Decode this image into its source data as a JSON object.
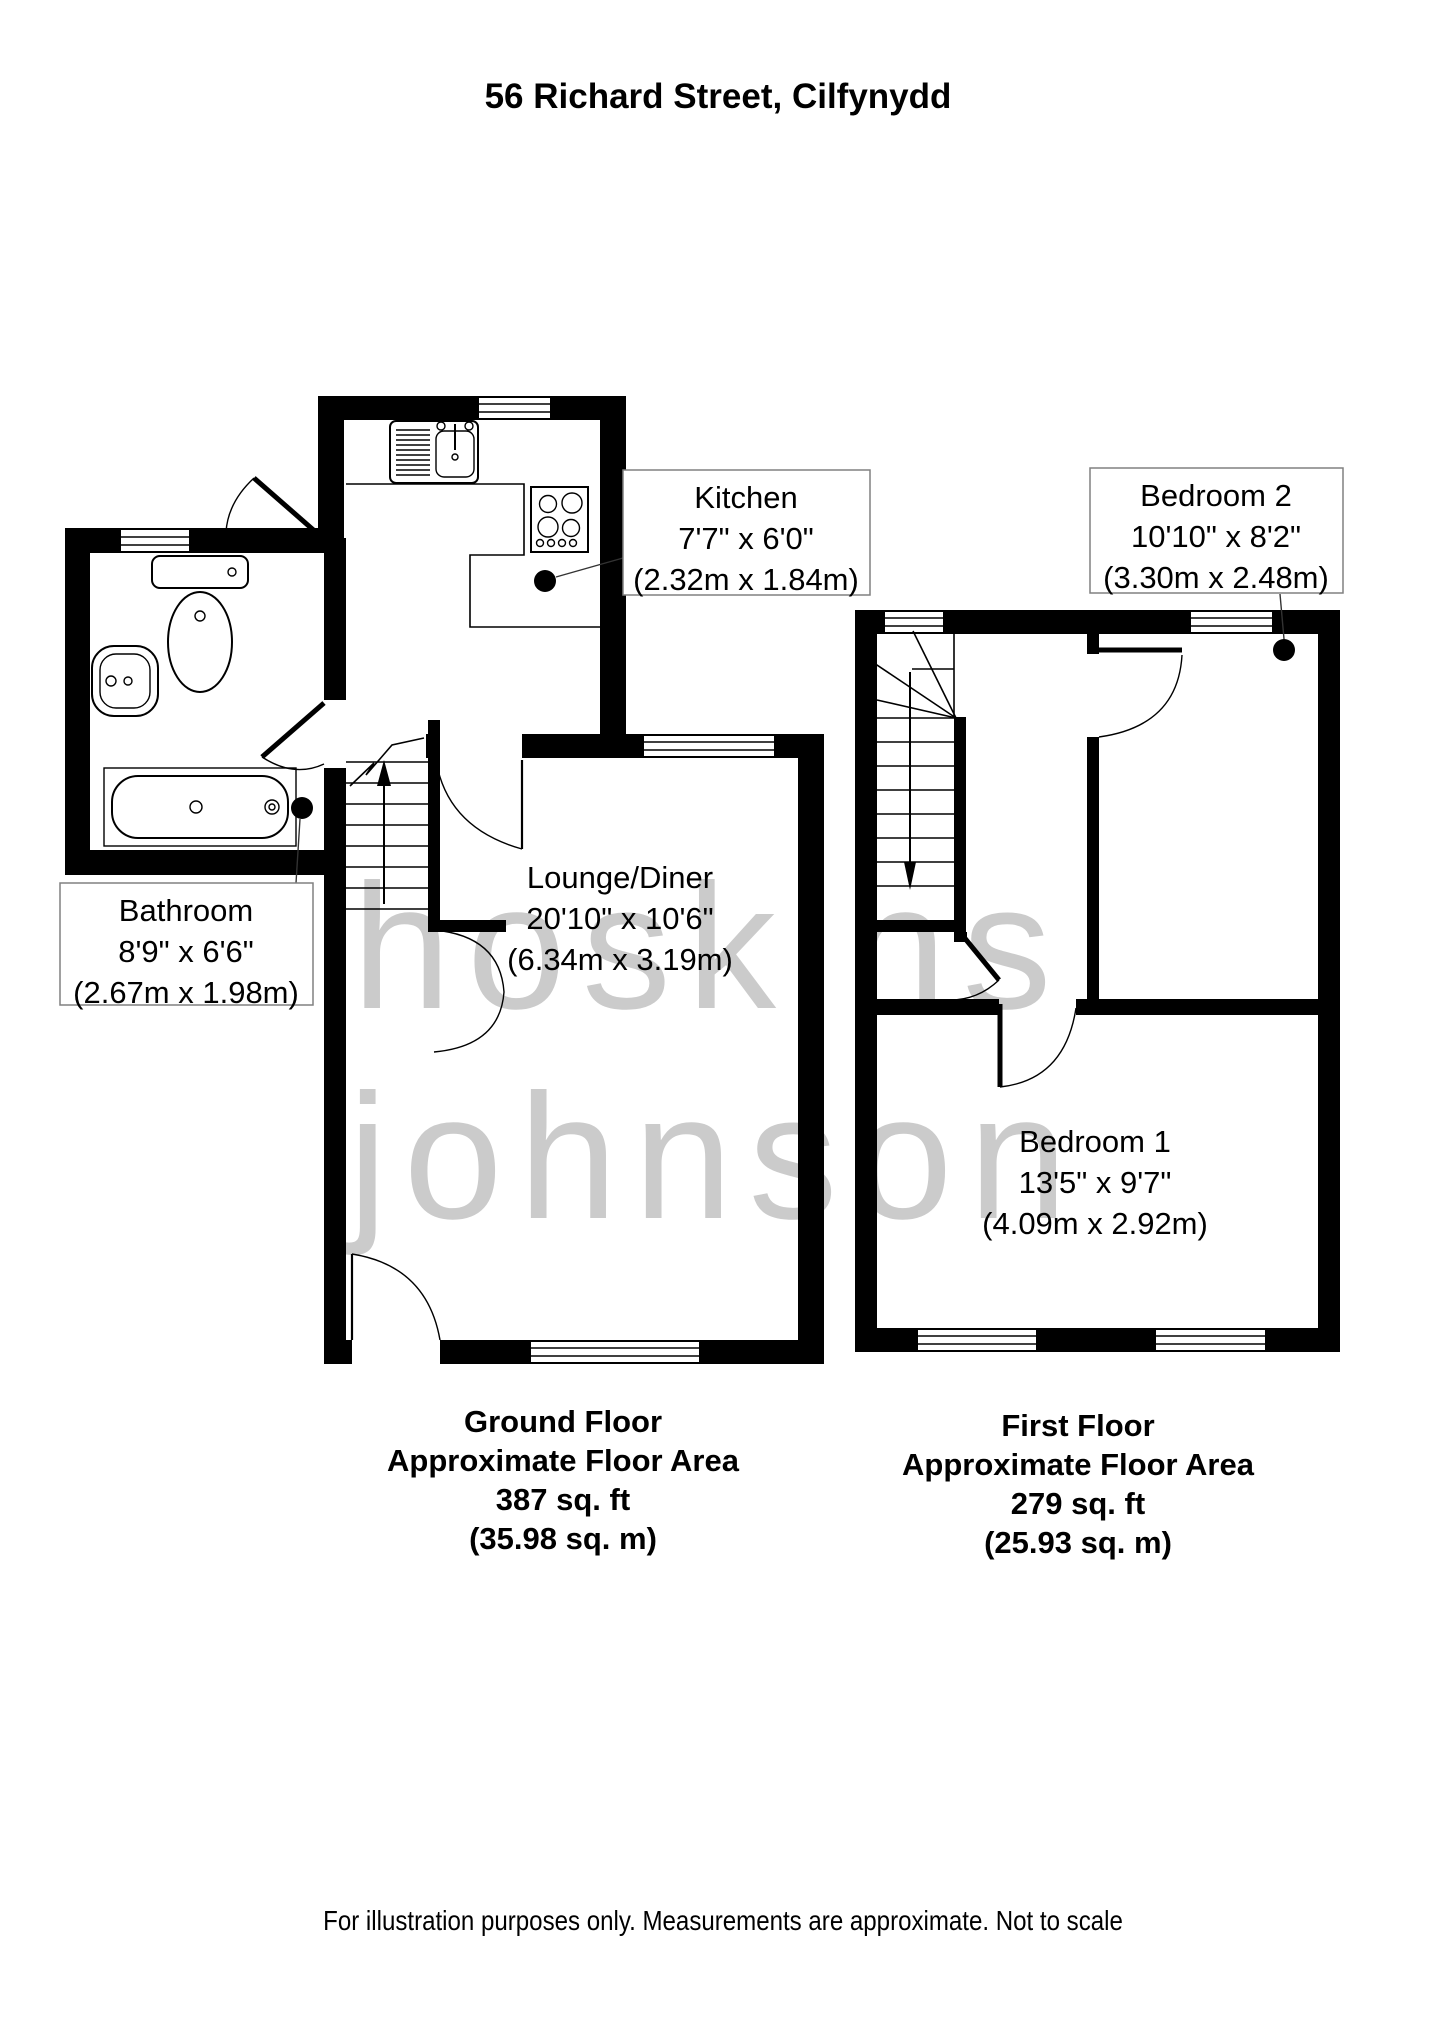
{
  "title": "56 Richard Street, Cilfynydd",
  "watermark": {
    "line1": "hoskins",
    "line2": "johnson"
  },
  "rooms": {
    "kitchen": {
      "name": "Kitchen",
      "imperial": "7'7\" x 6'0\"",
      "metric": "(2.32m x 1.84m)"
    },
    "bathroom": {
      "name": "Bathroom",
      "imperial": "8'9\" x 6'6\"",
      "metric": "(2.67m x 1.98m)"
    },
    "lounge": {
      "name": "Lounge/Diner",
      "imperial": "20'10\" x 10'6\"",
      "metric": "(6.34m x 3.19m)"
    },
    "bedroom2": {
      "name": "Bedroom 2",
      "imperial": "10'10\" x 8'2\"",
      "metric": "(3.30m x 2.48m)"
    },
    "bedroom1": {
      "name": "Bedroom 1",
      "imperial": "13'5\" x 9'7\"",
      "metric": "(4.09m x 2.92m)"
    }
  },
  "ground_floor_caption": {
    "line1": "Ground Floor",
    "line2": "Approximate Floor Area",
    "line3": "387 sq. ft",
    "line4": "(35.98 sq. m)"
  },
  "first_floor_caption": {
    "line1": "First Floor",
    "line2": "Approximate Floor Area",
    "line3": "279 sq. ft",
    "line4": "(25.93 sq. m)"
  },
  "footer": "For illustration purposes only. Measurements are approximate. Not to scale",
  "colors": {
    "wall": "#000000",
    "watermark": "#cbcbcb",
    "label_border": "#808080",
    "dot": "#000000",
    "background": "#ffffff"
  }
}
